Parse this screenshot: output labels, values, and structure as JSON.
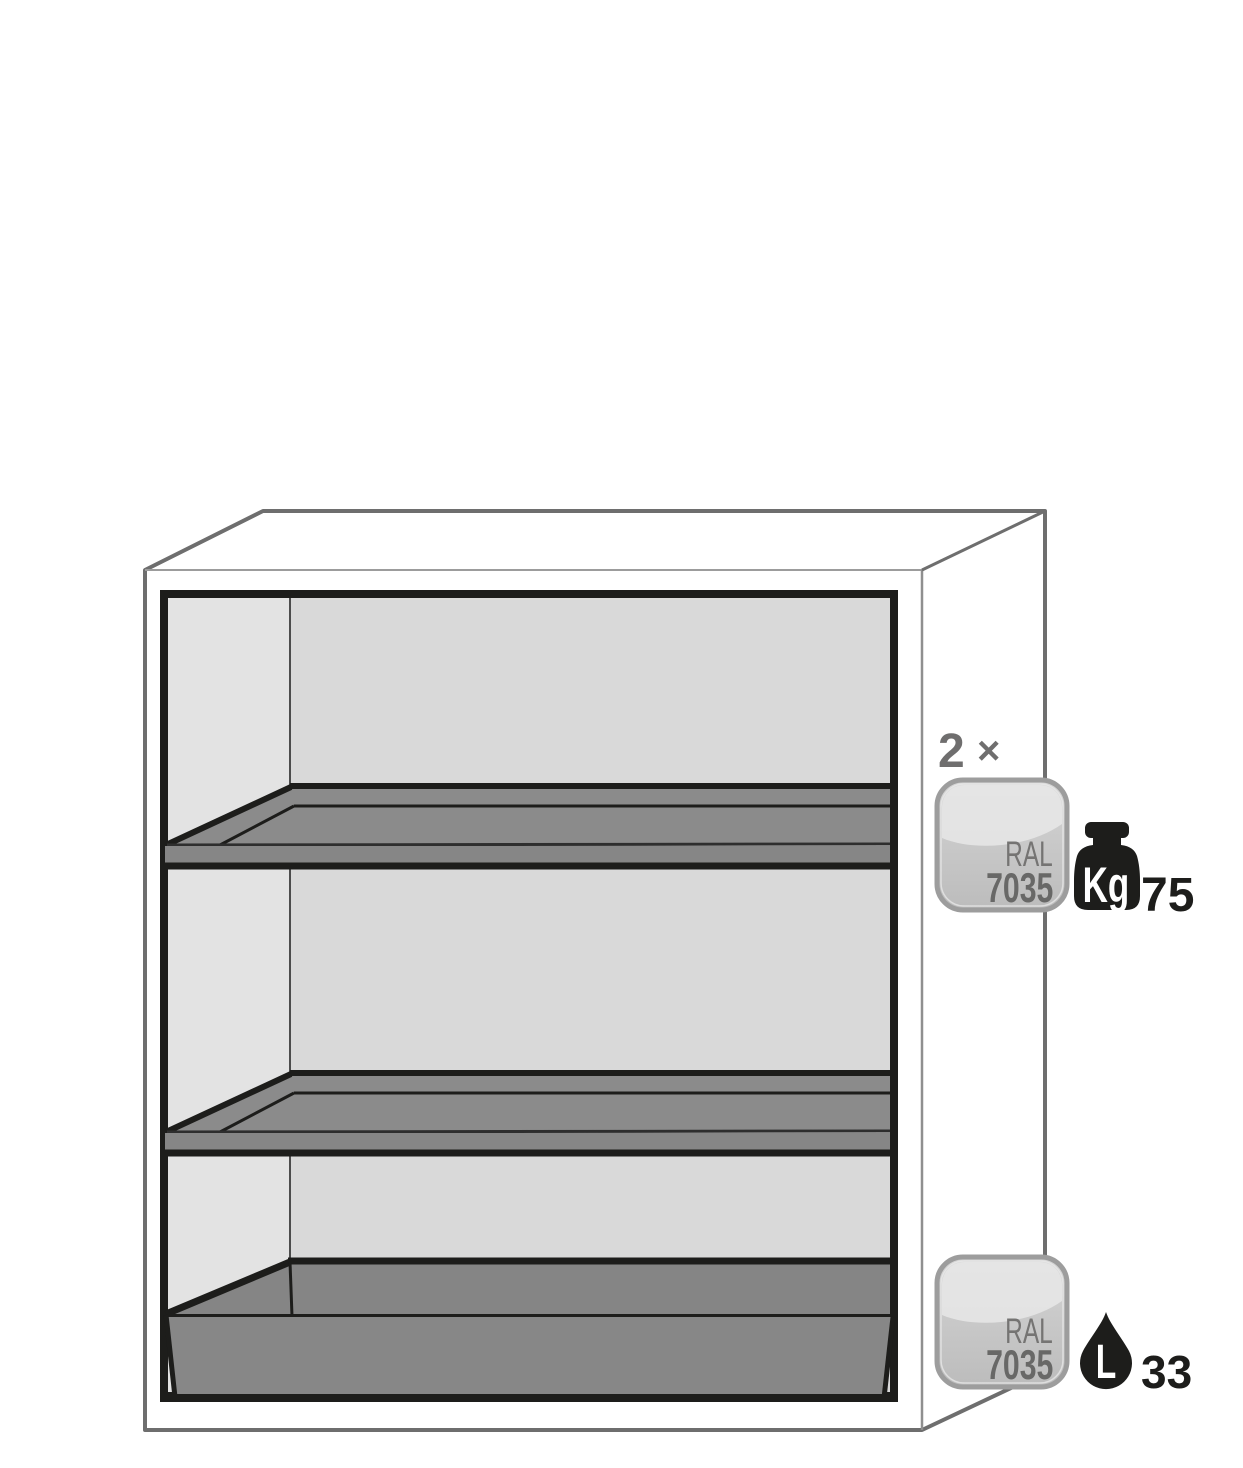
{
  "illustration": {
    "description": "safety cabinet cutaway with two shelves and bottom sump tray",
    "quantity": {
      "value": "2",
      "symbol": "×"
    },
    "shelf_badge": {
      "line1": "RAL",
      "line2": "7035"
    },
    "sump_badge": {
      "line1": "RAL",
      "line2": "7035"
    },
    "load_capacity": {
      "unit": "Kg",
      "value": "75"
    },
    "sump_volume": {
      "unit": "L",
      "value": "33"
    }
  },
  "colors": {
    "outline": "#6e6e6e",
    "frame_black": "#1d1d1b",
    "wall_back": "#d9d9d9",
    "wall_side": "#e3e3e3",
    "shelf_top": "#8b8b8b",
    "shelf_front": "#868686",
    "sump_inner": "#858585",
    "sump_front": "#878787",
    "badge_border": "#9d9d9d",
    "badge_text_light": "#757473",
    "badge_text_dark": "#686867",
    "annotation_gray": "#6f6e6e",
    "icon_black": "#1d1d1b"
  }
}
